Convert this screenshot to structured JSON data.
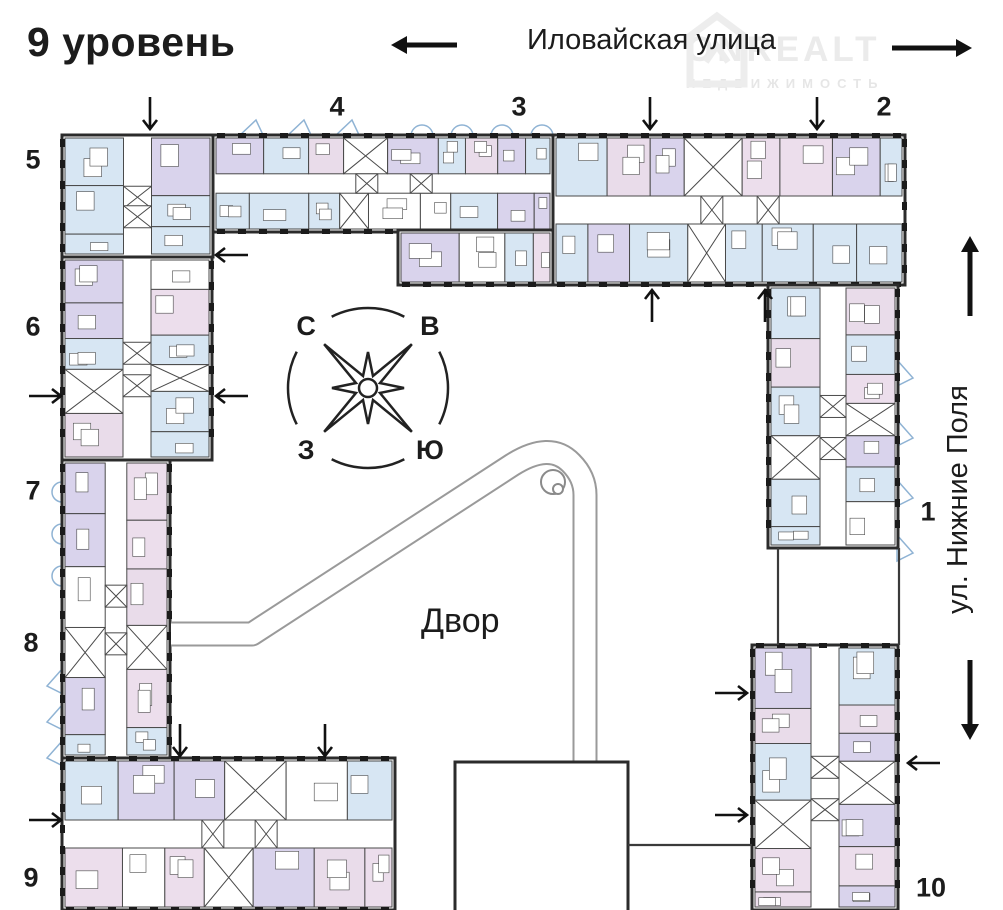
{
  "header": {
    "title": "9 уровень"
  },
  "streets": {
    "top": {
      "label": "Иловайская улица"
    },
    "right": {
      "label": "ул. Нижние Поля"
    }
  },
  "courtyard": {
    "label": "Двор"
  },
  "compass": {
    "north": "С",
    "east": "В",
    "west": "З",
    "south": "Ю"
  },
  "watermark": {
    "brand": "ONREALT",
    "subtitle": "НЕДВИЖИМОСТЬ"
  },
  "sections": [
    {
      "number": "5",
      "x": 33,
      "y": 160
    },
    {
      "number": "4",
      "x": 337,
      "y": 107
    },
    {
      "number": "3",
      "x": 519,
      "y": 107
    },
    {
      "number": "2",
      "x": 884,
      "y": 107
    },
    {
      "number": "6",
      "x": 33,
      "y": 327
    },
    {
      "number": "7",
      "x": 33,
      "y": 491
    },
    {
      "number": "8",
      "x": 31,
      "y": 643
    },
    {
      "number": "9",
      "x": 31,
      "y": 878
    },
    {
      "number": "1",
      "x": 928,
      "y": 512
    },
    {
      "number": "10",
      "x": 931,
      "y": 888
    }
  ],
  "colors": {
    "walls": "#2b2b2b",
    "room_stroke": "#4a4a4a",
    "tick": "#1b1b1b",
    "rooms": [
      "#d7e6f3",
      "#d9d3ec",
      "#ecdeec",
      "#e9dcea"
    ],
    "white": "#ffffff",
    "walkway": "#9a9a9a",
    "balcony": "#8fb3d4",
    "text": "#1c1c1c",
    "watermark": "#ebebeb"
  },
  "plan": {
    "blocks": [
      {
        "id": "top-strip-west",
        "x": 213,
        "y": 135,
        "w": 340,
        "h": 97,
        "orient": "h",
        "ticks": [
          "top",
          "bottom"
        ]
      },
      {
        "id": "top-strip-east",
        "x": 553,
        "y": 135,
        "w": 352,
        "h": 150,
        "orient": "h",
        "ticks": [
          "top",
          "bottom",
          "right"
        ]
      },
      {
        "id": "top-strip-inner",
        "x": 398,
        "y": 230,
        "w": 155,
        "h": 55,
        "orient": "h",
        "ticks": [
          "bottom"
        ]
      },
      {
        "id": "west-corner",
        "x": 62,
        "y": 135,
        "w": 151,
        "h": 122,
        "orient": "v",
        "ticks": [
          "left"
        ]
      },
      {
        "id": "west-strip-upper",
        "x": 62,
        "y": 257,
        "w": 150,
        "h": 203,
        "orient": "v",
        "ticks": [
          "left",
          "right"
        ]
      },
      {
        "id": "west-strip-lower",
        "x": 62,
        "y": 460,
        "w": 108,
        "h": 298,
        "orient": "v",
        "ticks": [
          "left",
          "right"
        ]
      },
      {
        "id": "east-strip",
        "x": 768,
        "y": 285,
        "w": 130,
        "h": 263,
        "orient": "v",
        "ticks": [
          "left",
          "right"
        ]
      },
      {
        "id": "southeast-tower",
        "x": 752,
        "y": 645,
        "w": 146,
        "h": 265,
        "orient": "v",
        "ticks": [
          "left",
          "right",
          "top"
        ]
      },
      {
        "id": "south-strip",
        "x": 62,
        "y": 758,
        "w": 333,
        "h": 152,
        "orient": "h",
        "ticks": [
          "top",
          "left",
          "bottom"
        ]
      }
    ],
    "structure_rect": {
      "x": 455,
      "y": 762,
      "w": 173,
      "h": 160
    },
    "walkway": {
      "path": "M 171 634 L 252 634 L 512 465 Q 550 441 571 463 Q 585 477 585 495 L 585 772",
      "ornament": {
        "cx": 553,
        "cy": 482,
        "r": 12,
        "cx2": 558,
        "cy2": 489,
        "r2": 5
      }
    },
    "connector_lines": [
      {
        "x1": 628,
        "y1": 845,
        "x2": 752,
        "y2": 845
      },
      {
        "x1": 778,
        "y1": 548,
        "x2": 778,
        "y2": 645
      },
      {
        "x1": 899,
        "y1": 548,
        "x2": 899,
        "y2": 645
      }
    ],
    "balconies": {
      "top_arcs": [
        422,
        462,
        502,
        542
      ],
      "top_tris": [
        238,
        286,
        334
      ],
      "left_circles": [
        492,
        534,
        576
      ],
      "left_tris": [
        668,
        704,
        740
      ],
      "right_tris": [
        360,
        420,
        480,
        535
      ]
    },
    "compass": {
      "cx": 368,
      "cy": 388,
      "arc_r": 80,
      "long_r": 62,
      "short_r": 36,
      "letter_r": 86
    }
  },
  "arrows": {
    "street": [
      {
        "x": 424,
        "y": 45,
        "angle": 180,
        "len": 66
      },
      {
        "x": 932,
        "y": 48,
        "angle": 0,
        "len": 80
      },
      {
        "x": 970,
        "y": 276,
        "angle": 270,
        "len": 80
      },
      {
        "x": 970,
        "y": 700,
        "angle": 90,
        "len": 80
      }
    ],
    "entrances": [
      {
        "x": 150,
        "y": 113,
        "dir": "down"
      },
      {
        "x": 650,
        "y": 113,
        "dir": "down"
      },
      {
        "x": 817,
        "y": 113,
        "dir": "down"
      },
      {
        "x": 232,
        "y": 255,
        "dir": "left"
      },
      {
        "x": 45,
        "y": 396,
        "dir": "right"
      },
      {
        "x": 232,
        "y": 396,
        "dir": "left"
      },
      {
        "x": 652,
        "y": 306,
        "dir": "up"
      },
      {
        "x": 765,
        "y": 306,
        "dir": "up"
      },
      {
        "x": 180,
        "y": 740,
        "dir": "down"
      },
      {
        "x": 325,
        "y": 740,
        "dir": "down"
      },
      {
        "x": 45,
        "y": 820,
        "dir": "right"
      },
      {
        "x": 731,
        "y": 693,
        "dir": "right"
      },
      {
        "x": 731,
        "y": 815,
        "dir": "right"
      },
      {
        "x": 924,
        "y": 763,
        "dir": "left"
      }
    ]
  }
}
